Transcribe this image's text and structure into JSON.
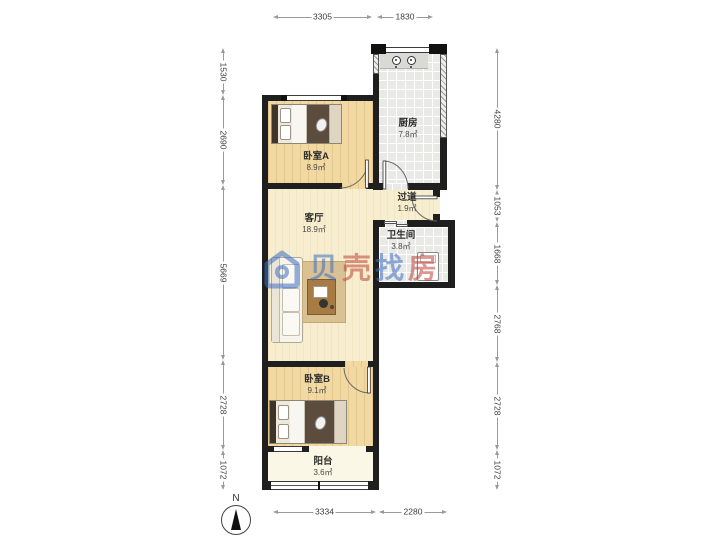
{
  "plan_title": "two-bedroom apartment floor plan",
  "rooms": {
    "bedroomA": {
      "name": "卧室A",
      "area": "8.9㎡"
    },
    "kitchen": {
      "name": "厨房",
      "area": "7.8㎡"
    },
    "hallway": {
      "name": "过道",
      "area": "1.9㎡"
    },
    "bathroom": {
      "name": "卫生间",
      "area": "3.8㎡"
    },
    "living": {
      "name": "客厅",
      "area": "18.9㎡"
    },
    "bedroomB": {
      "name": "卧室B",
      "area": "9.1㎡"
    },
    "balcony": {
      "name": "阳台",
      "area": "3.6㎡"
    }
  },
  "dimensions_mm": {
    "top": [
      {
        "value": "3305"
      },
      {
        "value": "1830"
      }
    ],
    "bottom": [
      {
        "value": "3334"
      },
      {
        "value": "2280"
      }
    ],
    "left": [
      {
        "value": "1530"
      },
      {
        "value": "2690"
      },
      {
        "value": "5669"
      },
      {
        "value": "2728"
      },
      {
        "value": "1072"
      }
    ],
    "right": [
      {
        "value": "4280"
      },
      {
        "value": "1053"
      },
      {
        "value": "1668"
      },
      {
        "value": "2768"
      },
      {
        "value": "2728"
      },
      {
        "value": "1072"
      }
    ]
  },
  "compass": {
    "north_label": "N"
  },
  "watermark": {
    "text": "贝壳找房",
    "chars": [
      {
        "text": "贝",
        "color": "#3d6fc4"
      },
      {
        "text": "壳",
        "color": "#bf4338"
      },
      {
        "text": "找",
        "color": "#3d6fc4"
      },
      {
        "text": "房",
        "color": "#bf4338"
      }
    ],
    "logo": "beike-house-logo",
    "brand_blue": "#3d6fc4",
    "brand_red": "#bf4338"
  },
  "icons": {
    "stove": "two-burner-stove-icon",
    "washer": "washing-machine-icon",
    "bed": "double-bed-icon",
    "sofa": "sofa-icon",
    "compass": "north-arrow-icon"
  },
  "colors": {
    "wall": "#1f1f1f",
    "wood_floor": "#f2d9a2",
    "living_floor": "#f7eecf",
    "tile_floor": "#e9e9e6",
    "balcony_floor": "#fbf7e6",
    "dimension_line": "#9a9a9a"
  }
}
